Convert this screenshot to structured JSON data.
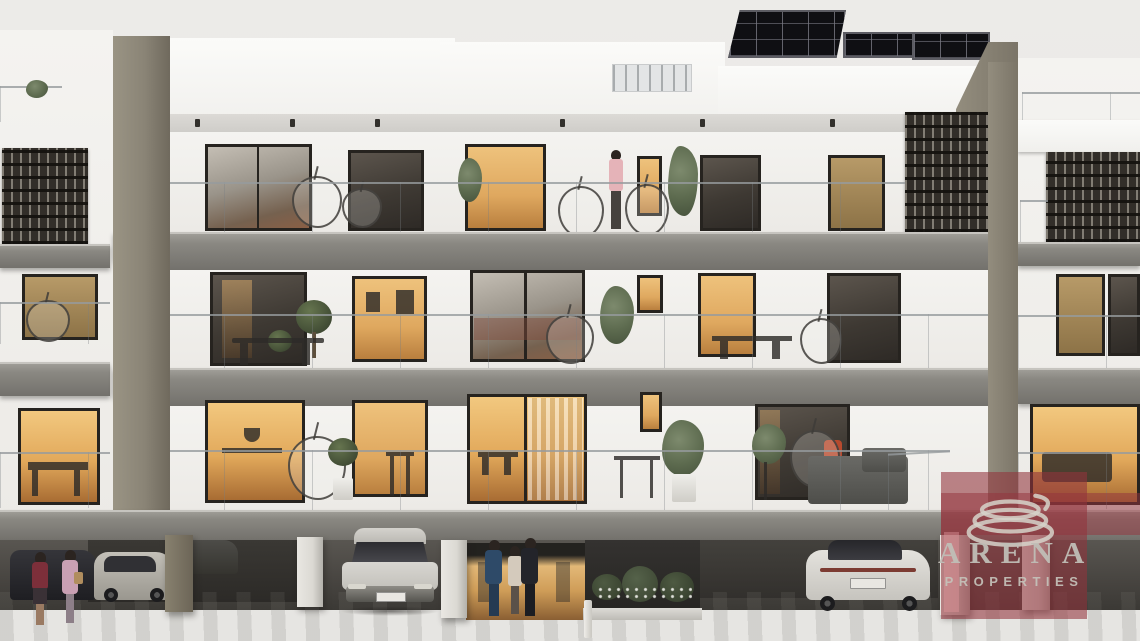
{
  "watermark": {
    "brand": "ARENA",
    "tagline": "PROPERTIES",
    "overlay_color": "#923d45",
    "text_color": "#c0beb6",
    "logo": "concentric-rings-icon"
  },
  "scene": {
    "type": "architectural exterior render",
    "building": {
      "storeys_above_parking": 3,
      "ground_level": "open parking garage",
      "roof": "flat roof with solar panel arrays",
      "balcony_railings": "frameless glass",
      "screens": "dark perforated lattice panels"
    },
    "counts": {
      "cars": 5,
      "people_at_ground": 5,
      "people_on_balcony": 1,
      "hanging_chairs": 8
    },
    "palette": {
      "sky": "#ecebe8",
      "facade_white": "#f4f3f0",
      "pillar_taupe": "#8a8476",
      "concrete_slab": "#8a8882",
      "window_frame": "#26231f",
      "warm_interior_glow": "#dfa85f",
      "lattice_dark": "#322e29",
      "parking_shadow": "#474440",
      "parking_floor": "#b5b3ae",
      "greenery": "#5d6b4f"
    }
  }
}
